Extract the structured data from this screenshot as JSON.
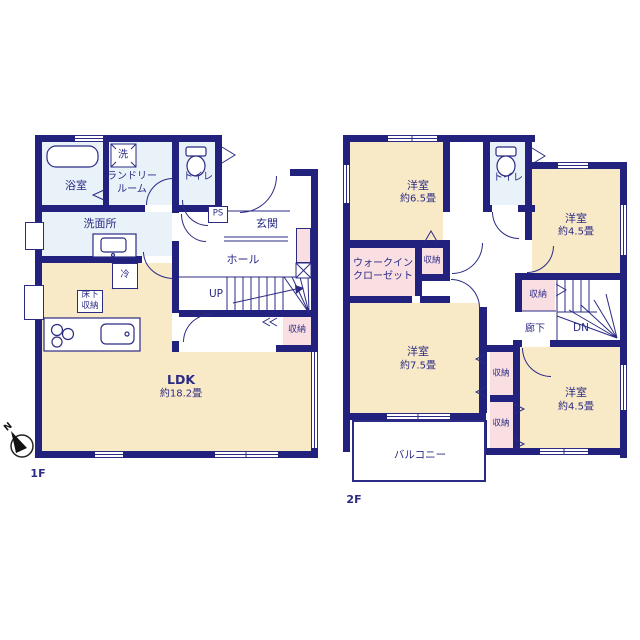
{
  "colors": {
    "wall": "#22227e",
    "room_cream": "#f8e9c7",
    "room_blue": "#e9f1f9",
    "room_pink": "#f9dee2",
    "line": "#2b2b85"
  },
  "floor1": {
    "label": "1F",
    "bathroom": "浴室",
    "washer": "洗",
    "laundry_line1": "ランドリー",
    "laundry_line2": "ルーム",
    "toilet": "トイレ",
    "washroom": "洗面所",
    "ps": "PS",
    "entrance": "玄関",
    "hall": "ホール",
    "up": "UP",
    "fridge": "冷",
    "underfloor_line1": "床下",
    "underfloor_line2": "収納",
    "ldk_name": "LDK",
    "ldk_size": "約18.2畳",
    "closet": "収納"
  },
  "floor2": {
    "label": "2F",
    "room65_name": "洋室",
    "room65_size": "約6.5畳",
    "toilet": "トイレ",
    "room45a_name": "洋室",
    "room45a_size": "約4.5畳",
    "wic_line1": "ウォークイン",
    "wic_line2": "クローゼット",
    "closet_wic": "収納",
    "closet_stairs": "収納",
    "closet_mid1": "収納",
    "closet_mid2": "収納",
    "corridor": "廊下",
    "dn": "DN",
    "room75_name": "洋室",
    "room75_size": "約7.5畳",
    "room45b_name": "洋室",
    "room45b_size": "約4.5畳",
    "balcony": "バルコニー"
  },
  "compass": {
    "north": "N"
  }
}
